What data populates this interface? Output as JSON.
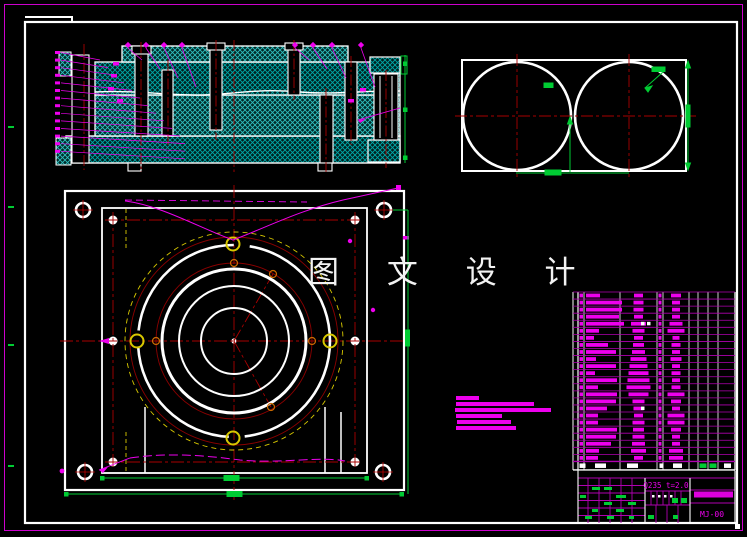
{
  "watermark": {
    "text": "图 文 设 计"
  },
  "title_block": {
    "material": "Q235 t=2.0",
    "drawing_no": "MJ-00"
  },
  "colors": {
    "bg": "#000000",
    "line_white": "#ffffff",
    "magenta": "#ee00ee",
    "magenta_grid": "#b000b0",
    "red_center": "#a80000",
    "dark_red": "#8b0000",
    "hatch_cyan": "#00a8a8",
    "green": "#00cc33",
    "yellow": "#d8c800"
  },
  "tech_notes": {
    "bars": [
      {
        "x": 456,
        "y": 396,
        "w": 23,
        "h": 4
      },
      {
        "x": 456,
        "y": 402,
        "w": 78,
        "h": 4
      },
      {
        "x": 455,
        "y": 408,
        "w": 96,
        "h": 4
      },
      {
        "x": 456,
        "y": 414,
        "w": 46,
        "h": 4
      },
      {
        "x": 457,
        "y": 420,
        "w": 54,
        "h": 4
      },
      {
        "x": 456,
        "y": 426,
        "w": 60,
        "h": 4
      }
    ]
  },
  "bom": {
    "left": 578,
    "right": 735,
    "top": 292,
    "row_h": 7.06,
    "header_h": 8.5,
    "col_lines": [
      584,
      620,
      657,
      663,
      689,
      698,
      708,
      718
    ],
    "rows": [
      {
        "code_w": 14,
        "name_w": 9,
        "mat_w": 10,
        "dots": 0
      },
      {
        "code_w": 36,
        "name_w": 10,
        "mat_w": 8,
        "dots": 0
      },
      {
        "code_w": 36,
        "name_w": 10,
        "mat_w": 8,
        "dots": 0
      },
      {
        "code_w": 33,
        "name_w": 9,
        "mat_w": 8,
        "dots": 0
      },
      {
        "code_w": 38,
        "name_w": 15,
        "mat_w": 13,
        "dots": 2
      },
      {
        "code_w": 13,
        "name_w": 12,
        "mat_w": 17,
        "dots": 0
      },
      {
        "code_w": 8,
        "name_w": 9,
        "mat_w": 7,
        "dots": 0
      },
      {
        "code_w": 22,
        "name_w": 11,
        "mat_w": 9,
        "dots": 0
      },
      {
        "code_w": 30,
        "name_w": 13,
        "mat_w": 8,
        "dots": 0
      },
      {
        "code_w": 10,
        "name_w": 16,
        "mat_w": 11,
        "dots": 0
      },
      {
        "code_w": 30,
        "name_w": 18,
        "mat_w": 8,
        "dots": 0
      },
      {
        "code_w": 9,
        "name_w": 20,
        "mat_w": 9,
        "dots": 0
      },
      {
        "code_w": 31,
        "name_w": 22,
        "mat_w": 8,
        "dots": 0
      },
      {
        "code_w": 12,
        "name_w": 24,
        "mat_w": 9,
        "dots": 0
      },
      {
        "code_w": 31,
        "name_w": 20,
        "mat_w": 17,
        "dots": 0
      },
      {
        "code_w": 30,
        "name_w": 12,
        "mat_w": 10,
        "dots": 0
      },
      {
        "code_w": 21,
        "name_w": 10,
        "mat_w": 8,
        "dots": 1
      },
      {
        "code_w": 12,
        "name_w": 9,
        "mat_w": 17,
        "dots": 0
      },
      {
        "code_w": 12,
        "name_w": 12,
        "mat_w": 17,
        "dots": 0
      },
      {
        "code_w": 31,
        "name_w": 11,
        "mat_w": 10,
        "dots": 0
      },
      {
        "code_w": 30,
        "name_w": 12,
        "mat_w": 8,
        "dots": 0
      },
      {
        "code_w": 25,
        "name_w": 13,
        "mat_w": 8,
        "dots": 0
      },
      {
        "code_w": 13,
        "name_w": 15,
        "mat_w": 14,
        "dots": 0
      },
      {
        "code_w": 12,
        "name_w": 9,
        "mat_w": 14,
        "dots": 0
      }
    ],
    "header_blobs": [
      {
        "x": 579.5,
        "w": 6,
        "c": "#ffffff"
      },
      {
        "x": 595,
        "w": 11,
        "c": "#ffffff"
      },
      {
        "x": 627,
        "w": 11,
        "c": "#ffffff"
      },
      {
        "x": 659.5,
        "w": 4,
        "c": "#ffffff"
      },
      {
        "x": 673,
        "w": 9,
        "c": "#ffffff"
      },
      {
        "x": 699.5,
        "w": 7,
        "c": "#00cc33"
      },
      {
        "x": 709.5,
        "w": 7,
        "c": "#00cc33"
      },
      {
        "x": 724,
        "w": 7,
        "c": "#ffffff"
      }
    ]
  },
  "section_view": {
    "top_callout_x": [
      128,
      146,
      164,
      182,
      295,
      313,
      332,
      361
    ],
    "left_callouts": {
      "count": 14,
      "x": 55,
      "y0": 51,
      "step": 7.6
    },
    "inner_labels": [
      [
        113,
        62
      ],
      [
        111,
        74
      ],
      [
        108,
        87
      ],
      [
        117,
        99
      ],
      [
        348,
        99
      ],
      [
        360,
        88
      ]
    ]
  },
  "title_grid": {
    "left_green_blobs": [
      [
        592,
        487,
        8,
        3
      ],
      [
        604,
        487,
        8,
        3
      ],
      [
        580,
        495,
        6,
        3
      ],
      [
        616,
        495,
        10,
        3
      ],
      [
        604,
        502,
        8,
        3
      ],
      [
        628,
        502,
        8,
        3
      ],
      [
        592,
        509,
        6,
        3
      ],
      [
        616,
        509,
        8,
        3
      ],
      [
        585,
        516,
        7,
        3
      ],
      [
        607,
        516,
        7,
        3
      ],
      [
        629,
        516,
        5,
        3
      ]
    ],
    "mid_green_blobs": [
      [
        672,
        498,
        6,
        5
      ],
      [
        681,
        498,
        6,
        5
      ],
      [
        648,
        515,
        6,
        4
      ],
      [
        673,
        515,
        5,
        4
      ]
    ],
    "mid_white_dots": [
      [
        652,
        495
      ],
      [
        658,
        495
      ],
      [
        664,
        495
      ],
      [
        670,
        495
      ]
    ]
  },
  "frame_ticks_y": [
    126,
    206,
    344,
    465
  ]
}
